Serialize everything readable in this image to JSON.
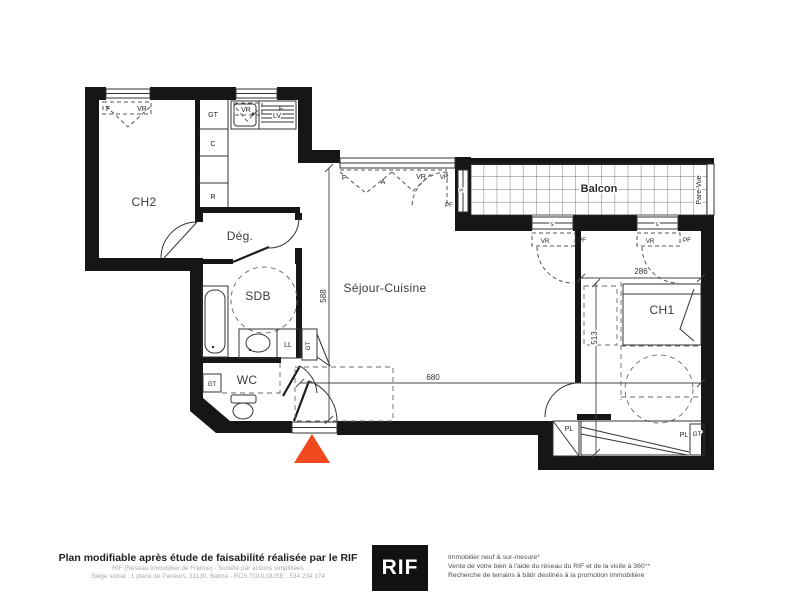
{
  "colors": {
    "wall": "#161616",
    "accent_arrow": "#f0481f",
    "line": "#333333",
    "muted_text": "#a9a9a9"
  },
  "rooms": {
    "ch2": "CH2",
    "degagement": "Dég.",
    "sdb": "SDB",
    "wc": "WC",
    "sejour": "Séjour-Cuisine",
    "balcon": "Balcon",
    "ch1": "CH1",
    "pare_vue": "Pare-Vue"
  },
  "labels": {
    "gt_kitchen": "GT",
    "c_kitchen": "C",
    "r_kitchen": "R",
    "lv": "LV",
    "ll": "LL",
    "gt_sdb": "GT",
    "gt_wc": "GT",
    "gt_ch1": "GT",
    "pl_left": "PL",
    "pl_right": "PL",
    "f_ch2": "F",
    "vr_ch2": "VR",
    "vr_kitchen": "VR",
    "f_kitchen": "F",
    "f_sejour": "F",
    "a_sejour": "A",
    "vr_sejour": "VR",
    "vr_bay": "VR",
    "pf_bay": "PF",
    "s_bay": "s",
    "s_sill1": "s",
    "s_sill2": "s",
    "vr_pf1": "VR",
    "pf_pf1": "PF",
    "vr_pf2": "VR",
    "pf_pf2": "PF"
  },
  "dimensions": {
    "sejour_width": "680",
    "sejour_depth": "588",
    "ch1_width": "286",
    "ch1_depth": "513"
  },
  "footer": {
    "title": "Plan modifiable après étude de faisabilité réalisée par le RIF",
    "company_line": "RIF (Réseau Immobilier de France) - Société par actions simplifiées",
    "address_line": "Siège social : 1 place de Paveurs, 31130, Balma - RCS TOULOUSE : 534 234 174",
    "logo": "RIF",
    "tagline1": "Immobilier neuf & sur-mesure*",
    "tagline2": "Vente de votre bien à l'aide du réseau du RIF et de la visite à 360°*",
    "tagline3": "Recherche de terrains à bâtir destinés à la promotion immobilière"
  }
}
